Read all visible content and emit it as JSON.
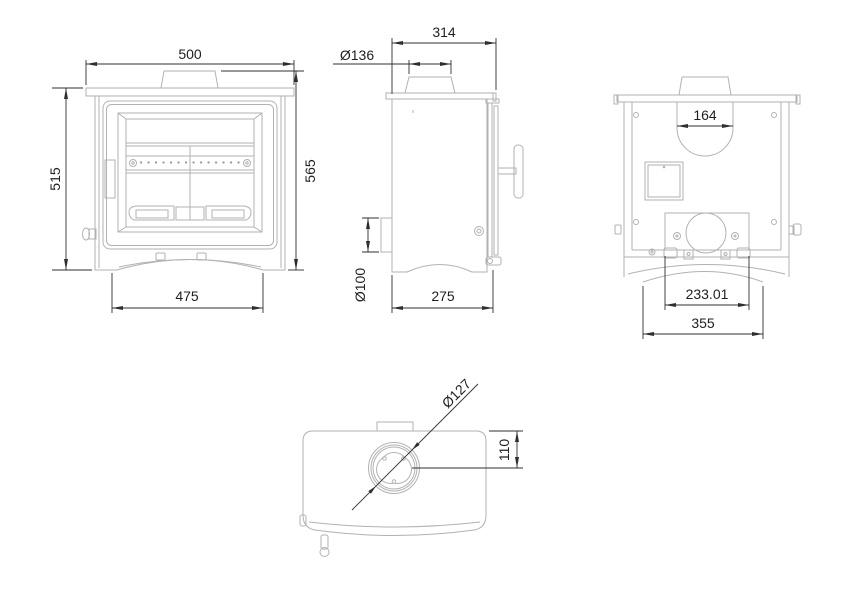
{
  "colors": {
    "background": "#ffffff",
    "geometry_line": "#b2b2b2",
    "dimension_line": "#2f2f2f",
    "dimension_text": "#1f1f1f"
  },
  "views": {
    "front": {
      "dimensions": {
        "top_width": "500",
        "left_height": "515",
        "right_height": "565",
        "bottom_width": "475"
      }
    },
    "side": {
      "dimensions": {
        "top_depth": "314",
        "flue_collar_diameter": "Ø136",
        "rear_inlet_diameter": "Ø100",
        "bottom_depth": "275"
      }
    },
    "rear": {
      "dimensions": {
        "flue_cutout_width": "164",
        "inlet_box_width": "233.01",
        "base_width": "355"
      }
    },
    "top": {
      "dimensions": {
        "flue_diameter": "Ø127",
        "flue_center_offset": "110"
      }
    }
  }
}
